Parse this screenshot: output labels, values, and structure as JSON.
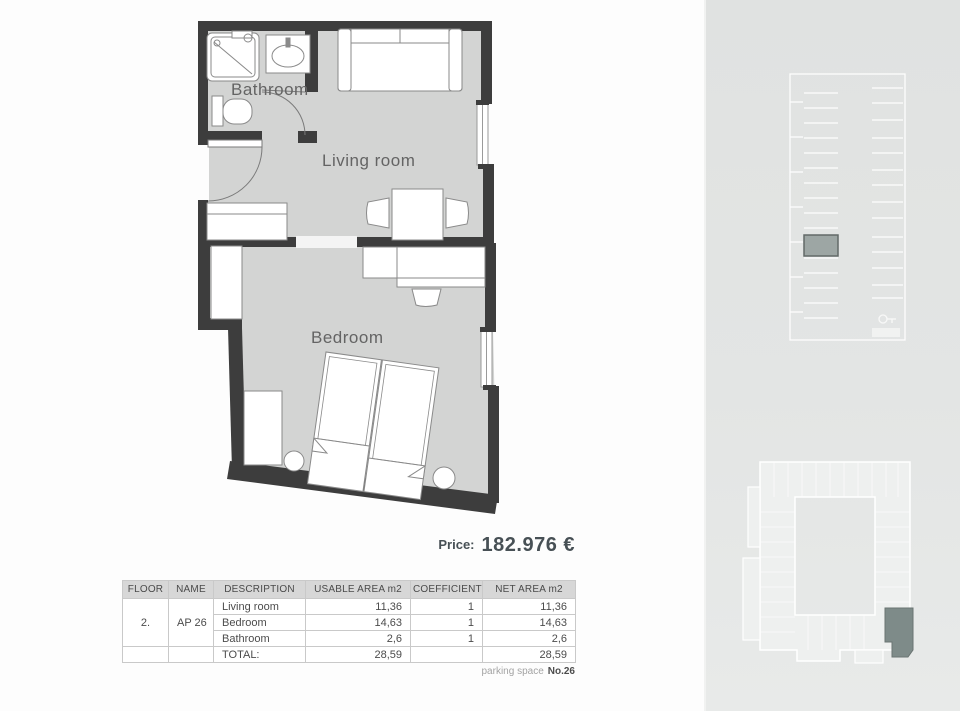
{
  "plan": {
    "rooms": {
      "bathroom": "Bathroom",
      "living": "Living room",
      "bedroom": "Bedroom"
    }
  },
  "price": {
    "label": "Price:",
    "value": "182.976 €"
  },
  "table": {
    "headers": [
      "FLOOR",
      "NAME",
      "DESCRIPTION",
      "USABLE AREA m2",
      "COEFFICIENT",
      "NET AREA m2"
    ],
    "floor": "2.",
    "name": "AP 26",
    "rows": [
      {
        "description": "Living room",
        "usable": "11,36",
        "coefficient": "1",
        "net": "11,36"
      },
      {
        "description": "Bedroom",
        "usable": "14,63",
        "coefficient": "1",
        "net": "14,63"
      },
      {
        "description": "Bathroom",
        "usable": "2,6",
        "coefficient": "1",
        "net": "2,6"
      }
    ],
    "total_label": "TOTAL:",
    "total_usable": "28,59",
    "total_coefficient": "",
    "total_net": "28,59"
  },
  "footer": {
    "parking_label": "parking space",
    "parking_number": "No.26"
  },
  "colors": {
    "wall": "#3d3d3d",
    "floor": "#d3d4d3",
    "sidebar": "#e3e5e4",
    "highlight_unit": "#7e8b89",
    "highlight_parking": "#9aa3a1",
    "price_text": "#475055"
  }
}
